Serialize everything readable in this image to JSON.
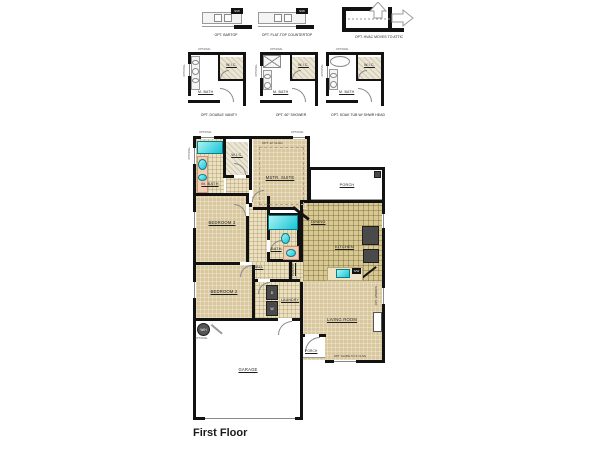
{
  "page": {
    "title": "First Floor"
  },
  "colors": {
    "wall": "#121212",
    "carpet": "#d9c89e",
    "tile_light": "#ebe1c2",
    "tile_kitchen": "#d8c892",
    "fixture_teal": "#17c4d6",
    "counter_pink": "#f2cdb2",
    "appliance": "#4a4a4a"
  },
  "options": {
    "optional_tag": "OPTIONAL",
    "sink_chip": "S/W",
    "row1": {
      "bartop": "OPT. BARTOP",
      "flattop": "OPT. FLAT-TOP COUNTERTOP",
      "hvac": "OPT. HVAC MOVES TO ATTIC"
    },
    "row2": {
      "double_vanity": "OPT. DOUBLE VANITY",
      "shower": "OPT. 60\" SHOWER",
      "soak_tub": "OPT. SOAK TUB W/ SHWR HEAD",
      "bath": "M. BATH",
      "closet": "W.I.C."
    }
  },
  "plan": {
    "rooms": {
      "master_bath": "M. BATH",
      "closet": "W.I.C.",
      "master": "MSTR. SUITE",
      "bedroom3": "BEDROOM 3",
      "bedroom2": "BEDROOM 2",
      "bath": "BATH",
      "hall": "HALL",
      "laundry": "LAUNDRY",
      "pantry": "PANTRY",
      "dining": "DINING",
      "kitchen": "KITCHEN",
      "living": "LIVING ROOM",
      "rear_porch": "PORCH",
      "front_porch": "PORCH",
      "garage": "GARAGE"
    },
    "notes": {
      "master_ceiling": "OPT. 12' CLNG",
      "living_side": "OPT. WINDOW",
      "living_front": "OPT. SLOPE TO 9' CLNG",
      "optional": "OPTIONAL",
      "water_heater": "W/H",
      "dryer": "D",
      "washer": "W",
      "sink_chip": "S/W"
    }
  }
}
